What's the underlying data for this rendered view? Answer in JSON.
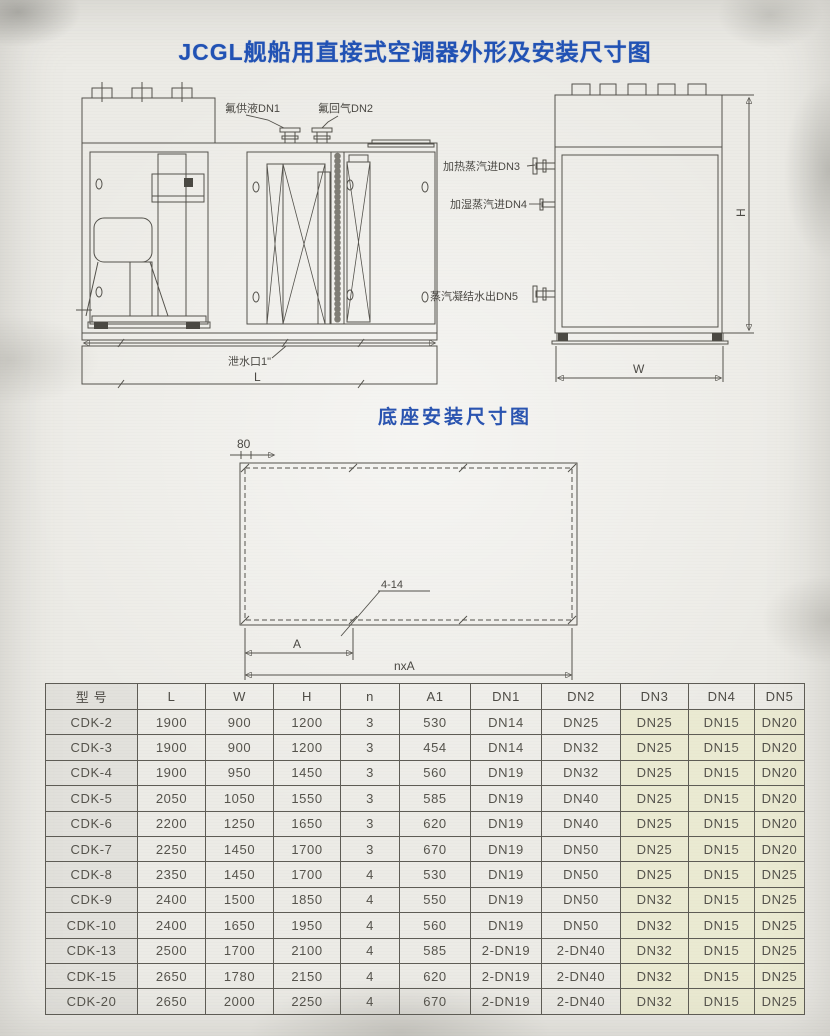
{
  "page": {
    "title": "JCGL舰船用直接式空调器外形及安装尺寸图"
  },
  "front_view": {
    "label_dn1": "氟供液DN1",
    "label_dn2": "氟回气DN2",
    "label_drain": "泄水口1\"",
    "dim_length": "L"
  },
  "side_view": {
    "label_dn3": "加热蒸汽进DN3",
    "label_dn4": "加湿蒸汽进DN4",
    "label_dn5": "蒸汽凝结水出DN5",
    "dim_width": "W",
    "dim_height": "H"
  },
  "base_diagram": {
    "title": "底座安装尺寸图",
    "dim_80": "80",
    "label_holes": "4-14",
    "dim_a": "A",
    "dim_nxa": "nxA"
  },
  "table": {
    "headers": [
      "型 号",
      "L",
      "W",
      "H",
      "n",
      "A1",
      "DN1",
      "DN2",
      "DN3",
      "DN4",
      "DN5"
    ],
    "rows": [
      [
        "CDK-2",
        "1900",
        "900",
        "1200",
        "3",
        "530",
        "DN14",
        "DN25",
        "DN25",
        "DN15",
        "DN20"
      ],
      [
        "CDK-3",
        "1900",
        "900",
        "1200",
        "3",
        "454",
        "DN14",
        "DN32",
        "DN25",
        "DN15",
        "DN20"
      ],
      [
        "CDK-4",
        "1900",
        "950",
        "1450",
        "3",
        "560",
        "DN19",
        "DN32",
        "DN25",
        "DN15",
        "DN20"
      ],
      [
        "CDK-5",
        "2050",
        "1050",
        "1550",
        "3",
        "585",
        "DN19",
        "DN40",
        "DN25",
        "DN15",
        "DN20"
      ],
      [
        "CDK-6",
        "2200",
        "1250",
        "1650",
        "3",
        "620",
        "DN19",
        "DN40",
        "DN25",
        "DN15",
        "DN20"
      ],
      [
        "CDK-7",
        "2250",
        "1450",
        "1700",
        "3",
        "670",
        "DN19",
        "DN50",
        "DN25",
        "DN15",
        "DN20"
      ],
      [
        "CDK-8",
        "2350",
        "1450",
        "1700",
        "4",
        "530",
        "DN19",
        "DN50",
        "DN25",
        "DN15",
        "DN25"
      ],
      [
        "CDK-9",
        "2400",
        "1500",
        "1850",
        "4",
        "550",
        "DN19",
        "DN50",
        "DN32",
        "DN15",
        "DN25"
      ],
      [
        "CDK-10",
        "2400",
        "1650",
        "1950",
        "4",
        "560",
        "DN19",
        "DN50",
        "DN32",
        "DN15",
        "DN25"
      ],
      [
        "CDK-13",
        "2500",
        "1700",
        "2100",
        "4",
        "585",
        "2-DN19",
        "2-DN40",
        "DN32",
        "DN15",
        "DN25"
      ],
      [
        "CDK-15",
        "2650",
        "1780",
        "2150",
        "4",
        "620",
        "2-DN19",
        "2-DN40",
        "DN32",
        "DN15",
        "DN25"
      ],
      [
        "CDK-20",
        "2650",
        "2000",
        "2250",
        "4",
        "670",
        "2-DN19",
        "2-DN40",
        "DN32",
        "DN15",
        "DN25"
      ]
    ]
  }
}
